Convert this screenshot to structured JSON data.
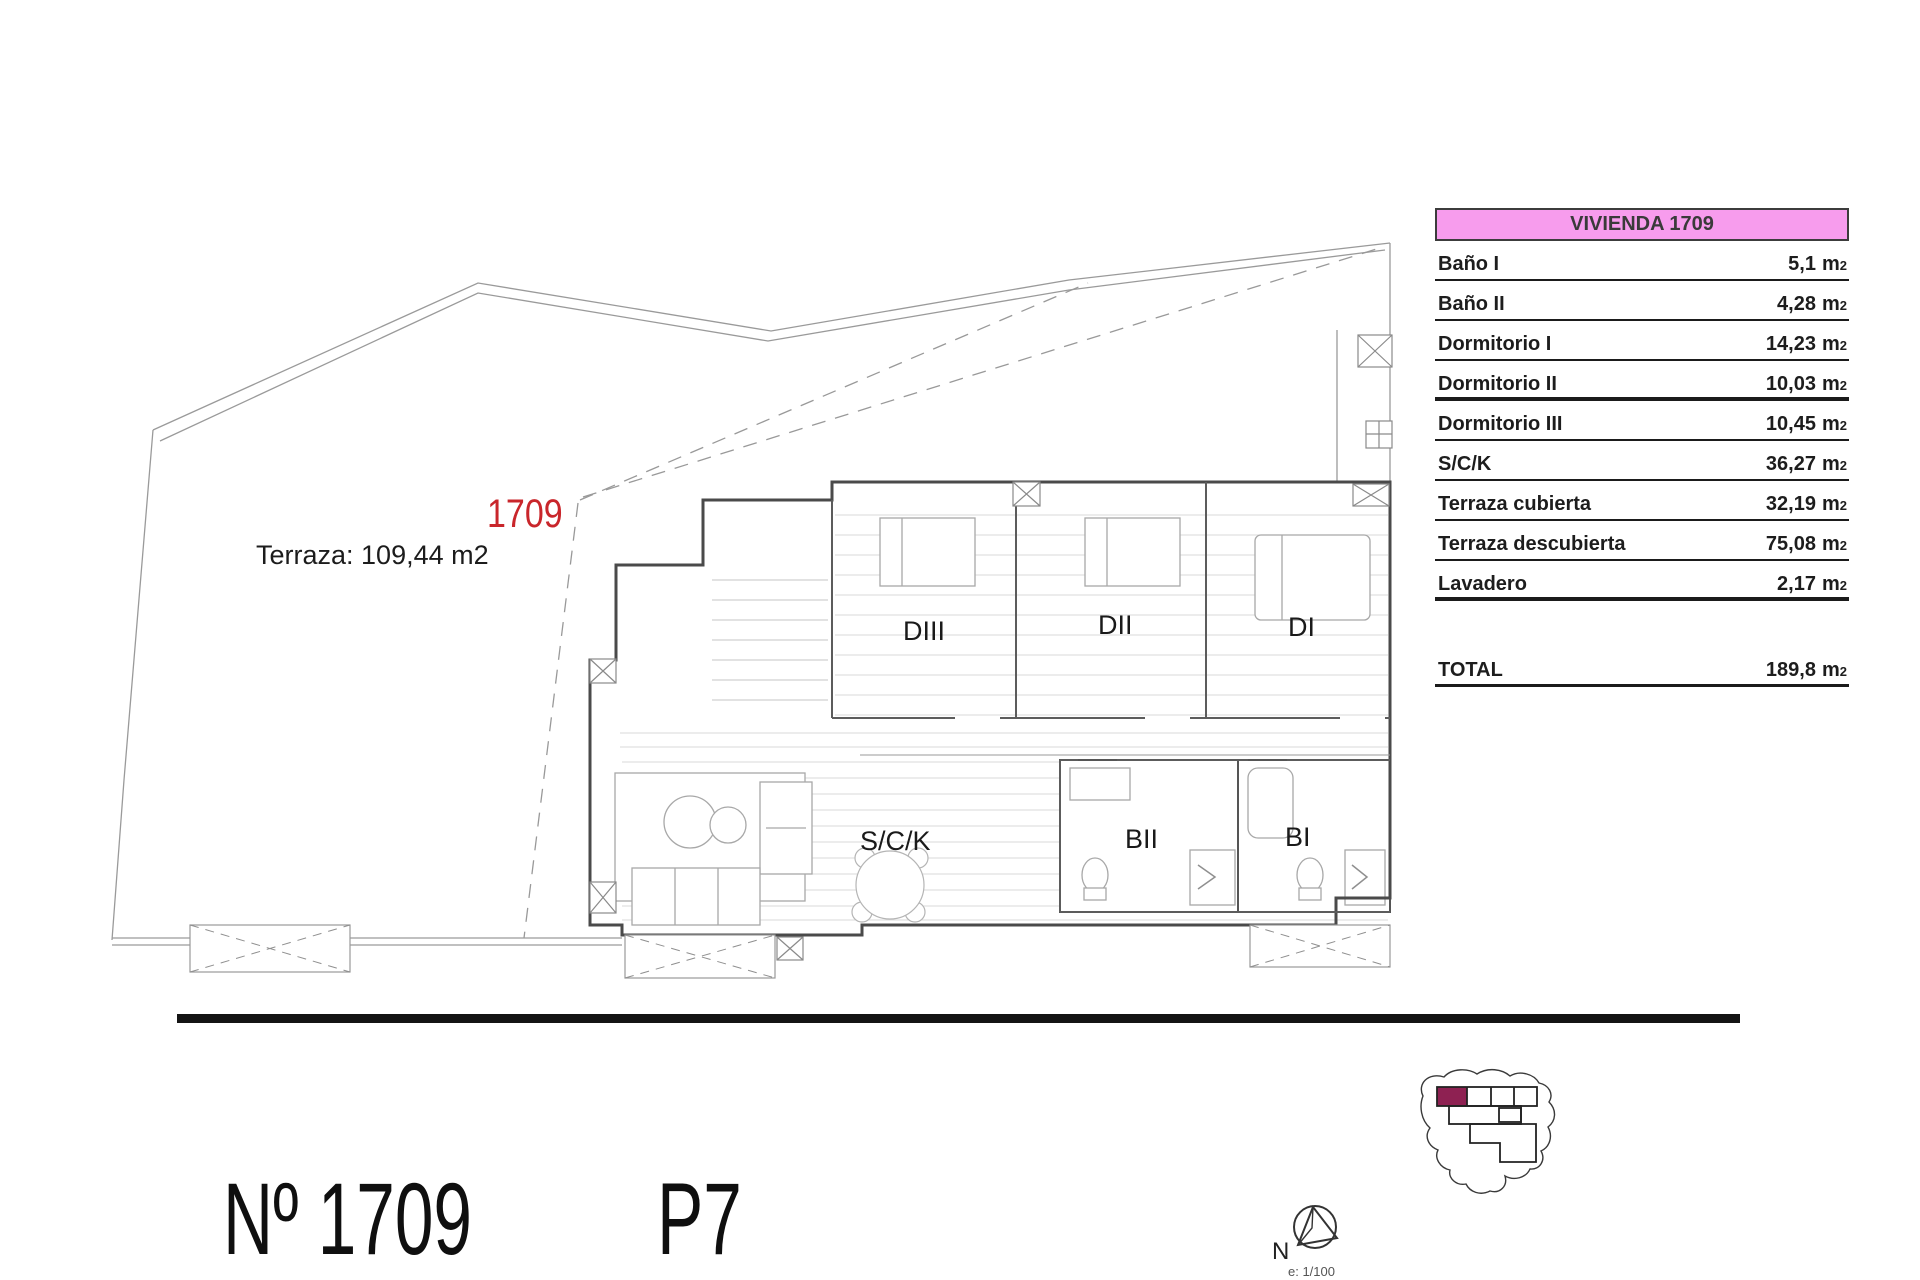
{
  "colors": {
    "header_pink": "#f79ced",
    "unit_red": "#c9262b",
    "keyplan_highlight": "#8e2152"
  },
  "table": {
    "title": "VIVIENDA 1709",
    "unit": "m",
    "unit_sup": "2",
    "rows": [
      {
        "label": "Baño I",
        "value": "5,1"
      },
      {
        "label": "Baño II",
        "value": "4,28"
      },
      {
        "label": "Dormitorio I",
        "value": "14,23"
      },
      {
        "label": "Dormitorio II",
        "value": "10,03"
      },
      {
        "label": "Dormitorio III",
        "value": "10,45"
      },
      {
        "label": "S/C/K",
        "value": "36,27"
      },
      {
        "label": "Terraza cubierta",
        "value": "32,19"
      },
      {
        "label": "Terraza descubierta",
        "value": "75,08"
      },
      {
        "label": "Lavadero",
        "value": "2,17"
      }
    ],
    "total_label": "TOTAL",
    "total_value": "189,8"
  },
  "plan": {
    "unit_number": "1709",
    "terrace_note": "Terraza: 109,44 m2",
    "room_labels": {
      "diii": "DIII",
      "dii": "DII",
      "di": "DI",
      "sck": "S/C/K",
      "bii": "BII",
      "bi": "BI"
    }
  },
  "footer": {
    "unit_title": "Nº 1709",
    "floor_label": "P7"
  },
  "compass": {
    "north_label": "N",
    "scale_label": "e: 1/100"
  }
}
